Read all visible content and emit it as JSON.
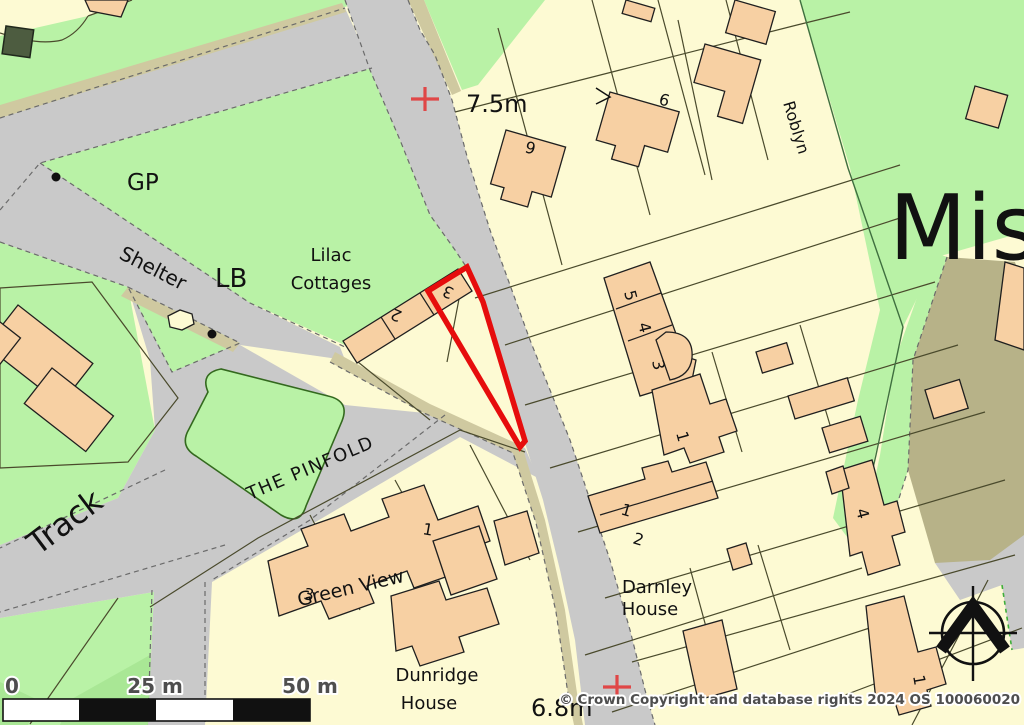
{
  "colors": {
    "parcel_fill": "#fdfad3",
    "green_fill": "#b9f2a6",
    "green_dark_fill": "#a9e795",
    "road_fill": "#c9c9c9",
    "path_fill": "#cfc9a0",
    "scrub_fill": "#b7b288",
    "building_fill": "#f7d0a3",
    "plot_outline": "#e60d0d",
    "grid_cross": "#e04747"
  },
  "labels": {
    "gp": "GP",
    "lb": "LB",
    "shelter": "Shelter",
    "lilac_line1": "Lilac",
    "lilac_line2": "Cottages",
    "the_pinfold": "THE PINFOLD",
    "track": "Track",
    "green_view": "Green View",
    "dunridge_line1": "Dunridge",
    "dunridge_line2": "House",
    "darnley_line1": "Darnley",
    "darnley_line2": "House",
    "roblyn": "Roblyn",
    "place_name": "Mis",
    "spot_height_top": "7.5m",
    "spot_height_bottom": "6.8m"
  },
  "house_numbers": {
    "n9": "9",
    "n6": "6",
    "cottage_2": "2",
    "cottage_3": "3",
    "terrace_5": "5",
    "terrace_4": "4",
    "terrace_3": "3",
    "terrace_1": "1",
    "pair_1": "1",
    "pair_2": "2",
    "green_view_3": "3",
    "green_view_1": "1",
    "east_4": "4",
    "southeast_1": "1"
  },
  "scale_bar": {
    "zero": "0",
    "mid": "25 m",
    "end": "50 m"
  },
  "attribution": "© Crown Copyright and database rights 2024 OS 100060020"
}
